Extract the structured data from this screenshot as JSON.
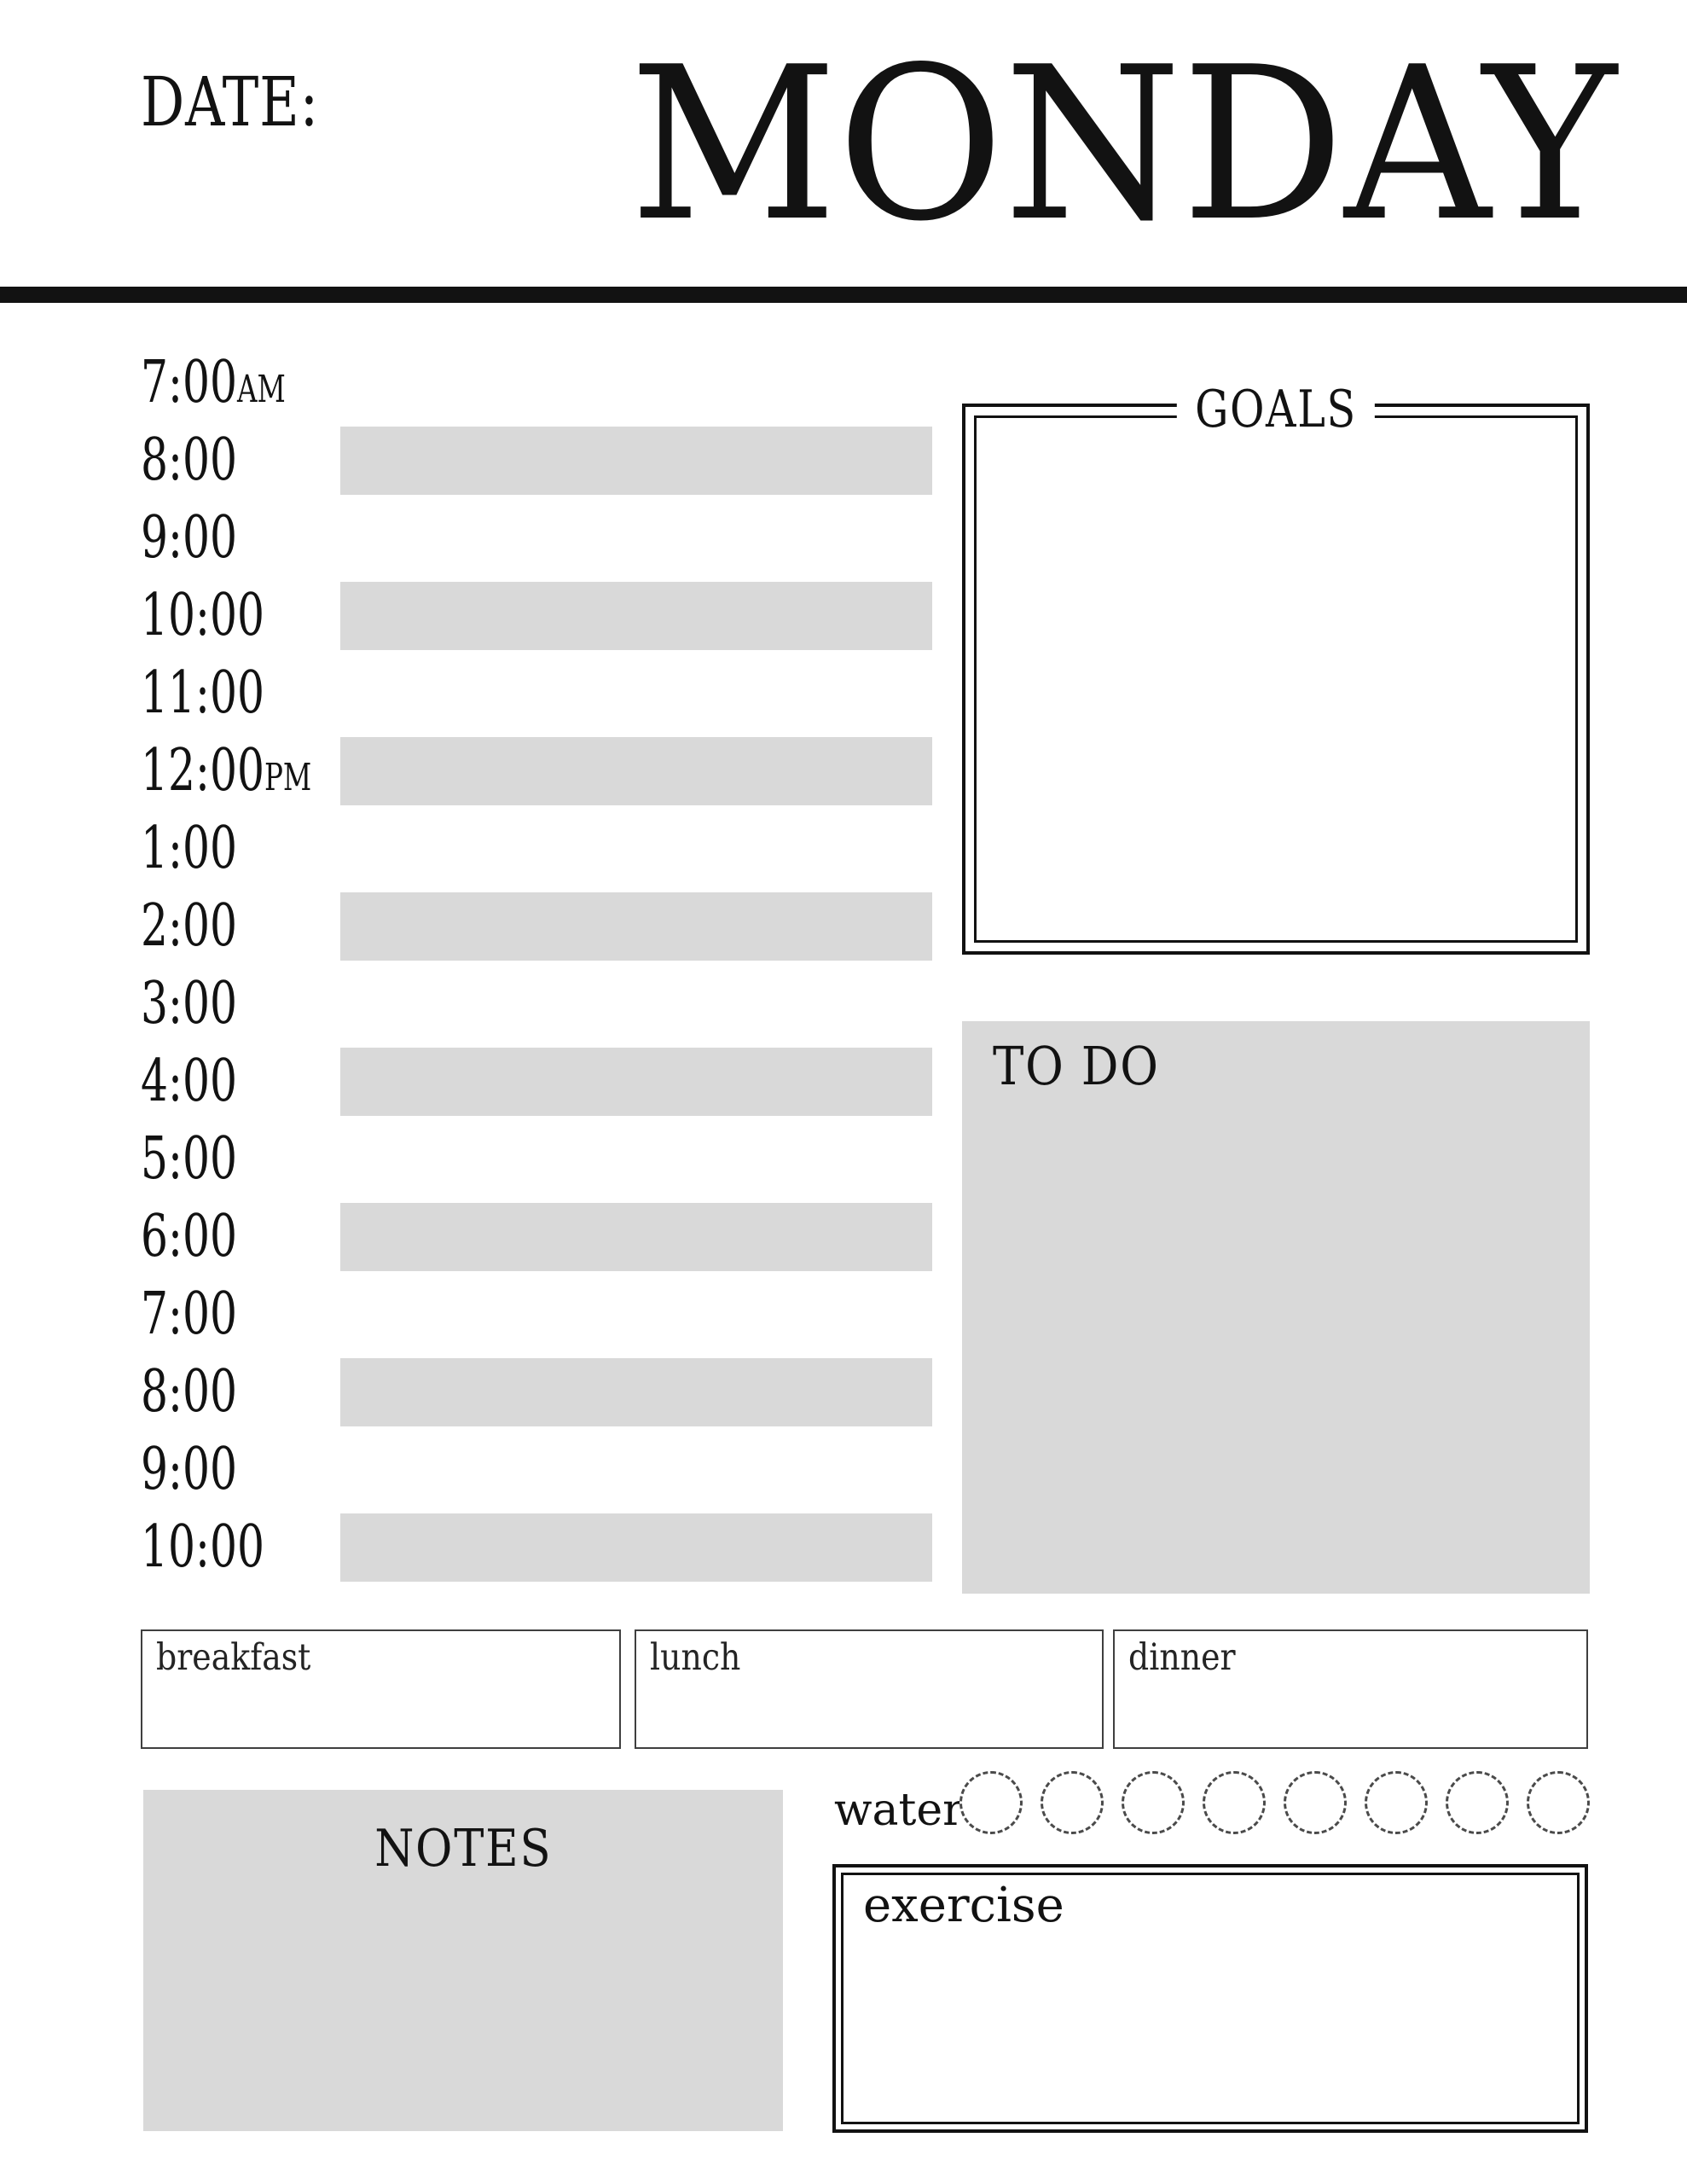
{
  "header": {
    "date_label": "DATE:",
    "day_title": "MONDAY"
  },
  "schedule": {
    "rows": [
      {
        "time": "7:00",
        "suffix": "AM",
        "shaded": false
      },
      {
        "time": "8:00",
        "suffix": "",
        "shaded": true
      },
      {
        "time": "9:00",
        "suffix": "",
        "shaded": false
      },
      {
        "time": "10:00",
        "suffix": "",
        "shaded": true
      },
      {
        "time": "11:00",
        "suffix": "",
        "shaded": false
      },
      {
        "time": "12:00",
        "suffix": "PM",
        "shaded": true
      },
      {
        "time": "1:00",
        "suffix": "",
        "shaded": false
      },
      {
        "time": "2:00",
        "suffix": "",
        "shaded": true
      },
      {
        "time": "3:00",
        "suffix": "",
        "shaded": false
      },
      {
        "time": "4:00",
        "suffix": "",
        "shaded": true
      },
      {
        "time": "5:00",
        "suffix": "",
        "shaded": false
      },
      {
        "time": "6:00",
        "suffix": "",
        "shaded": true
      },
      {
        "time": "7:00",
        "suffix": "",
        "shaded": false
      },
      {
        "time": "8:00",
        "suffix": "",
        "shaded": true
      },
      {
        "time": "9:00",
        "suffix": "",
        "shaded": false
      },
      {
        "time": "10:00",
        "suffix": "",
        "shaded": true
      }
    ]
  },
  "goals": {
    "title": "GOALS"
  },
  "todo": {
    "title": "TO DO"
  },
  "meals": {
    "items": [
      {
        "label": "breakfast"
      },
      {
        "label": "lunch"
      },
      {
        "label": "dinner"
      }
    ]
  },
  "notes": {
    "title": "NOTES"
  },
  "water": {
    "label": "water",
    "glass_count": 8
  },
  "exercise": {
    "label": "exercise"
  },
  "colors": {
    "ink": "#121212",
    "shade": "#d9d9d9",
    "meal_border": "#3f3f3f",
    "circle_dash": "#4a4a4a"
  }
}
